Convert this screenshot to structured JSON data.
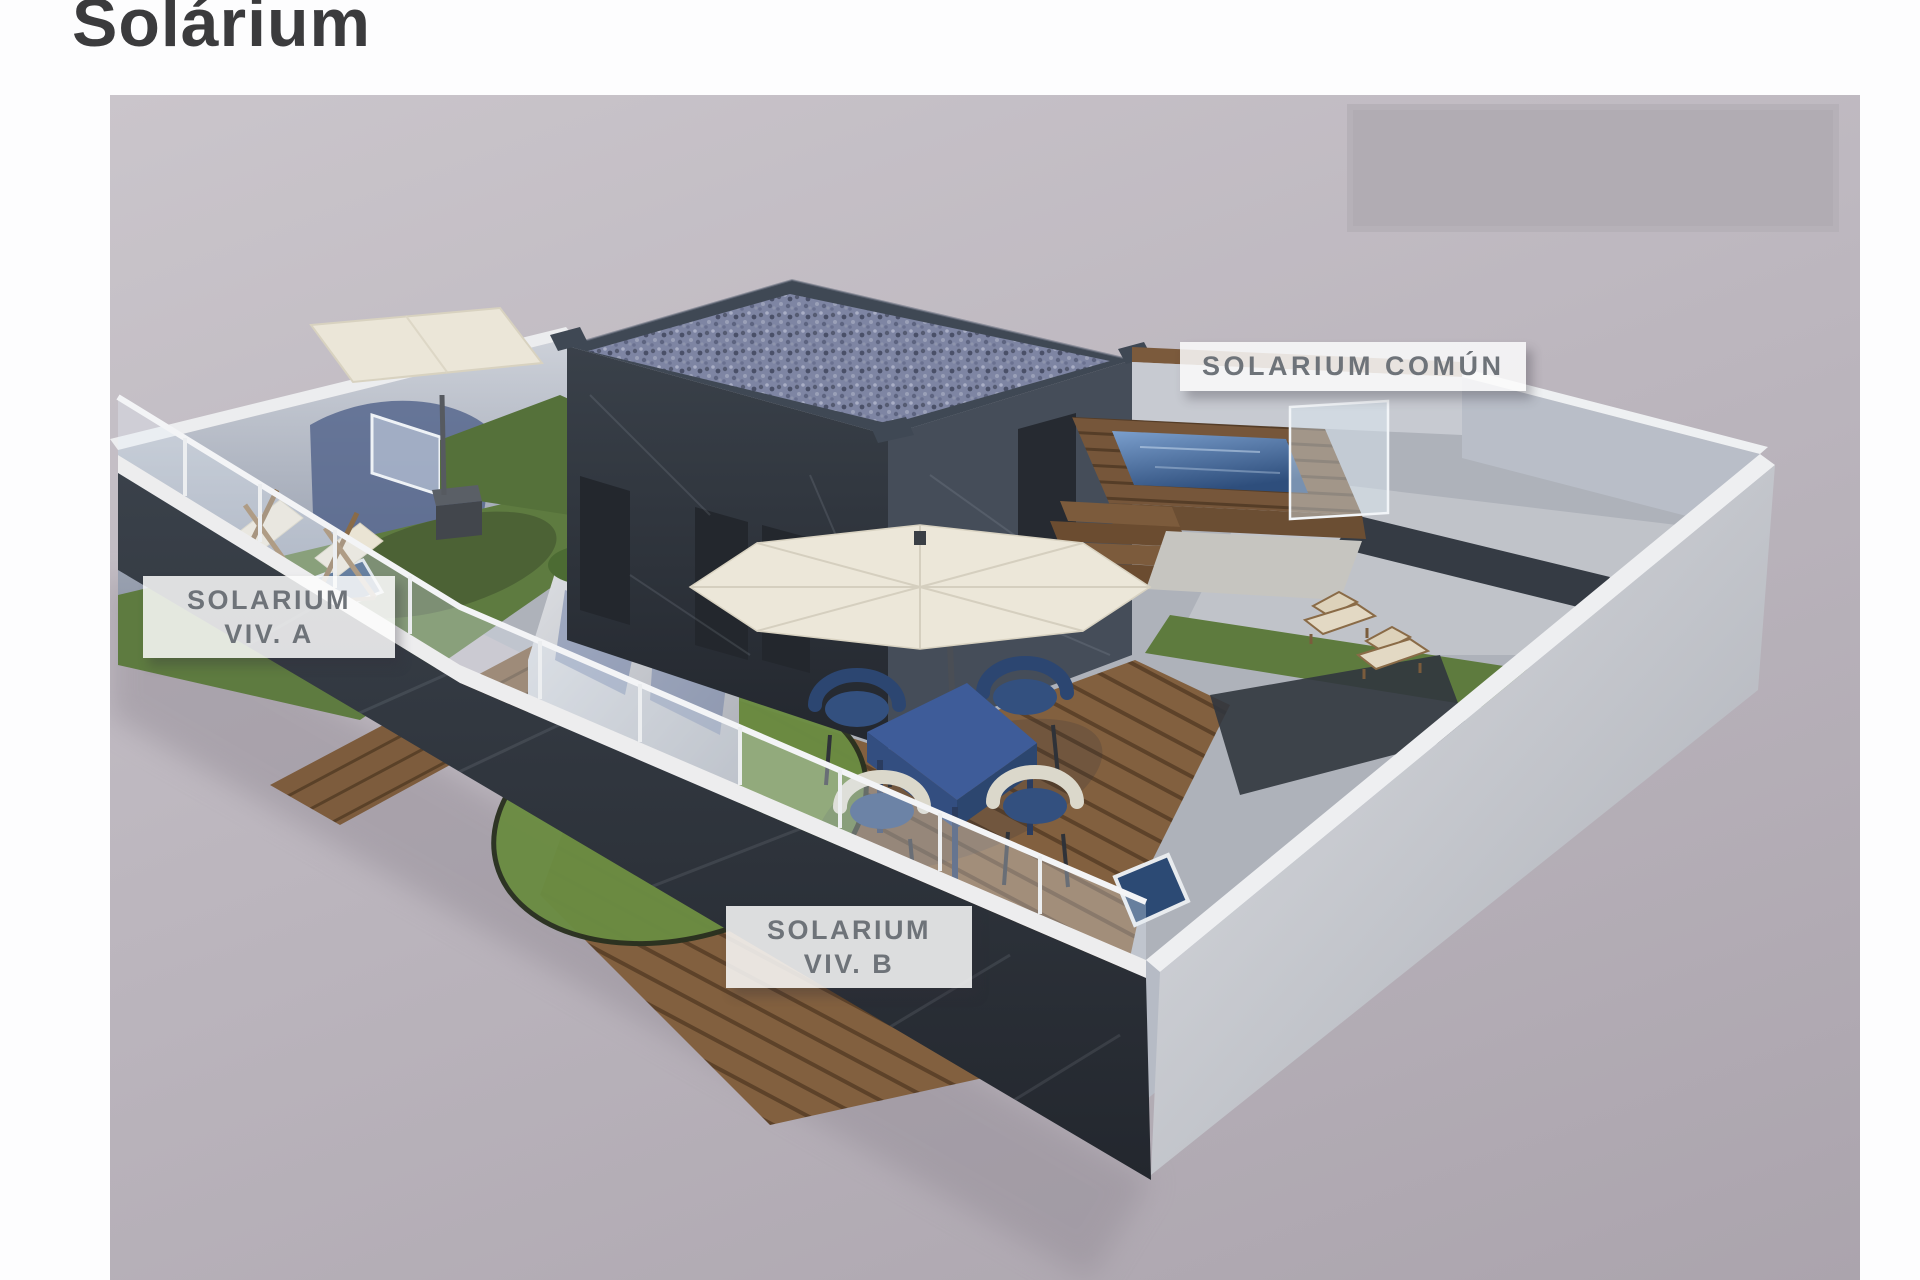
{
  "page": {
    "title": "Solárium"
  },
  "scene": {
    "labels": {
      "comun": "SOLARIUM COMÚN",
      "viv_a": [
        "SOLARIUM",
        "VIV. A"
      ],
      "viv_b": [
        "SOLARIUM",
        "VIV. B"
      ]
    }
  },
  "palette": {
    "page_background": "#fdfdfe",
    "ground": "#b7b1b9",
    "placeholder_box": "#b1acb3",
    "label_background": "rgba(252,252,252,0.85)",
    "label_text": "#6e7379",
    "title_text": "#3b3b3d",
    "dark_marble_wall": "#30363e",
    "light_wall": "#c6cad2",
    "wood_deck": "#82603f",
    "grass": "#5e7b40",
    "pool_water": "#3a5f92",
    "umbrella_canopy": "#ece7d9",
    "furniture_navy": "#2c4671",
    "furniture_cream": "#e9e3d3"
  }
}
